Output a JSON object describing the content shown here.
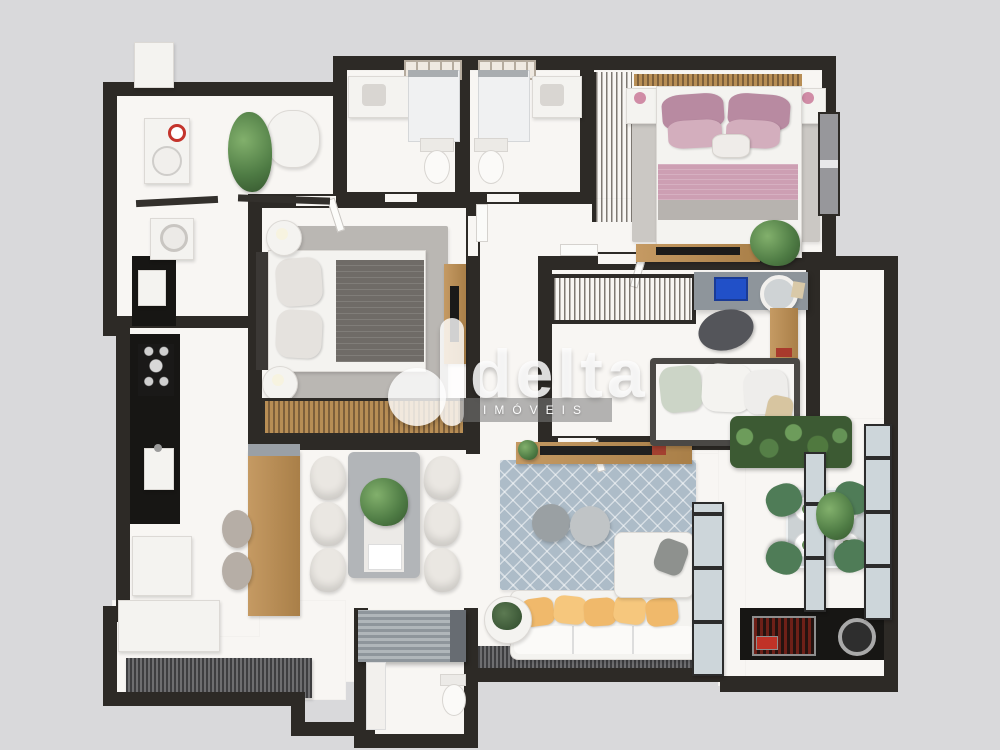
{
  "watermark": {
    "brand": "delta",
    "subtitle": "IMÓVEIS",
    "logo_icon": "delta-circle-logo-mark"
  },
  "palette": {
    "background": "#d9d9db",
    "wall": "#2d2a26",
    "floor": "#f8f6f3",
    "wood": "#c0945e",
    "wood_dark": "#7d5f3b",
    "counter_black": "#171614",
    "rug_gray": "#bab7b3",
    "rug_blue": "#adbcc8",
    "bed_pink_band": "#cd9fb3",
    "bed_pink_pillow": "#b88aa1",
    "pillow_yellow": "#f0b96b",
    "chair_green": "#4f7c57",
    "plant_green": "#55854c",
    "blanket_gray": "#6f6b67",
    "furniture_gray": "#8e959b",
    "white_furniture": "#f4f3f0",
    "glass": "#cdd6da",
    "deck_dark": "#4a4a4c",
    "grill_red": "#c03227"
  }
}
